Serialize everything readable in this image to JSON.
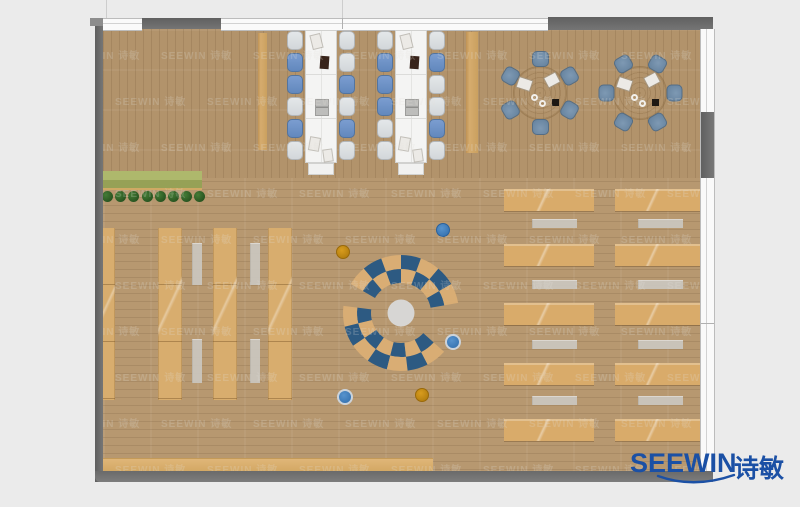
{
  "logo": {
    "brand": "SEEWIN",
    "brand_cn": "诗敏",
    "color": "#1b50a5"
  },
  "watermark": {
    "text": "SEEWIN 诗敏",
    "rows": 10,
    "cols": 7,
    "x0": -34,
    "y0": 18,
    "dx": 92,
    "dy": 46,
    "stagger": 46
  },
  "palette": {
    "background": "#ebebeb",
    "wall": "#6d6d6d",
    "floor_wood": "#b79870",
    "shelf_wood": "#d8ad6e",
    "desk_wood": "#d9ab6a",
    "table_white": "#f4f4f3",
    "chair_white": "#dadde0",
    "chair_blue": "#6b90c5",
    "chair_slate": "#6e8ba7",
    "arc_blue": "#2d5a82",
    "arc_tan": "#d9ad74",
    "bench_green": "#a3ad62",
    "stool_blue": "#3f7ec0",
    "stool_orange": "#c78c15",
    "logo_blue": "#1b50a5"
  },
  "scene": {
    "units": "stage px, 800x507",
    "long_tables": [
      {
        "x": 305,
        "chairs_left": [
          "w",
          "b",
          "b",
          "w",
          "b",
          "w"
        ],
        "chairs_right": [
          "w",
          "w",
          "b",
          "w",
          "b",
          "w"
        ]
      },
      {
        "x": 395,
        "chairs_left": [
          "w",
          "b",
          "b",
          "b",
          "w",
          "w"
        ],
        "chairs_right": [
          "w",
          "b",
          "w",
          "w",
          "b",
          "w"
        ]
      }
    ],
    "long_table_items": [
      {
        "t": "paper",
        "dx": 7,
        "dy": 5,
        "w": 9,
        "h": 13,
        "r": -14
      },
      {
        "t": "book",
        "dx": 15,
        "dy": 26,
        "w": 9,
        "h": 13,
        "r": 4
      },
      {
        "t": "laptop",
        "dx": 11,
        "dy": 70,
        "w": 12,
        "h": 15,
        "r": 0
      },
      {
        "t": "paper",
        "dx": 5,
        "dy": 108,
        "w": 9,
        "h": 12,
        "r": 10
      },
      {
        "t": "paper",
        "dx": 19,
        "dy": 120,
        "w": 8,
        "h": 11,
        "r": -8
      }
    ],
    "side_panels": [
      [
        258,
        33,
        9,
        117
      ],
      [
        466,
        32,
        12,
        121
      ]
    ],
    "round_tables": [
      {
        "cx": 540,
        "cy": 93,
        "angle0": 30
      },
      {
        "cx": 640,
        "cy": 93,
        "angle0": 0
      }
    ],
    "round_table_items": [
      {
        "t": "paper",
        "dx": -22,
        "dy": -14,
        "w": 13,
        "h": 10,
        "r": 18
      },
      {
        "t": "paper",
        "dx": 6,
        "dy": -18,
        "w": 12,
        "h": 10,
        "r": -28
      },
      {
        "t": "cup",
        "dx": -9,
        "dy": 1,
        "w": 7,
        "h": 7,
        "r": 0
      },
      {
        "t": "cup",
        "dx": -1,
        "dy": 7,
        "w": 7,
        "h": 7,
        "r": 0
      },
      {
        "t": "black",
        "dx": 12,
        "dy": 6,
        "w": 7,
        "h": 7,
        "r": 0
      }
    ],
    "green_bench": {
      "x": 98,
      "y": 171,
      "w": 104,
      "h": 19,
      "plants": 8
    },
    "shelf_columns": [
      [
        98,
        17
      ],
      [
        158,
        24
      ],
      [
        213,
        24
      ],
      [
        268,
        24
      ]
    ],
    "shelf_top": 228,
    "shelf_height": 172,
    "shelf_gray": {
      "xs": [
        192,
        250
      ],
      "w": 10,
      "segs": [
        [
          243,
          42
        ],
        [
          339,
          44
        ]
      ]
    },
    "desk_cols": [
      [
        504,
        90
      ],
      [
        615,
        86
      ]
    ],
    "desk_rows": [
      189,
      244,
      303,
      363,
      419
    ],
    "desk_row_h": 22,
    "desk_gray_rows": [
      219,
      280,
      340,
      396
    ],
    "desk_gray": {
      "offsets": [
        28,
        23
      ],
      "w": 45,
      "h": 9
    },
    "bottom_bench": [
      100,
      458,
      333,
      13
    ],
    "stools": [
      {
        "x": 443,
        "y": 230,
        "r": 7,
        "c": "blue"
      },
      {
        "x": 343,
        "y": 252,
        "r": 7,
        "c": "orange"
      },
      {
        "x": 453,
        "y": 342,
        "r": 8,
        "c": "blue",
        "ring": true
      },
      {
        "x": 345,
        "y": 397,
        "r": 8,
        "c": "blue",
        "ring": true
      },
      {
        "x": 422,
        "y": 395,
        "r": 7,
        "c": "orange"
      }
    ],
    "central": {
      "cx": 401,
      "cy": 313,
      "core_r": 13.5,
      "bands": [
        [
          30,
          44
        ],
        [
          44,
          58
        ]
      ],
      "arcs": [
        {
          "a0": 10,
          "a1": 150
        },
        {
          "a0": 173,
          "a1": 318
        }
      ],
      "segments": 7,
      "blue": "#2d5a82",
      "tan": "#d9ad74",
      "core": "#d7d6d4"
    }
  }
}
